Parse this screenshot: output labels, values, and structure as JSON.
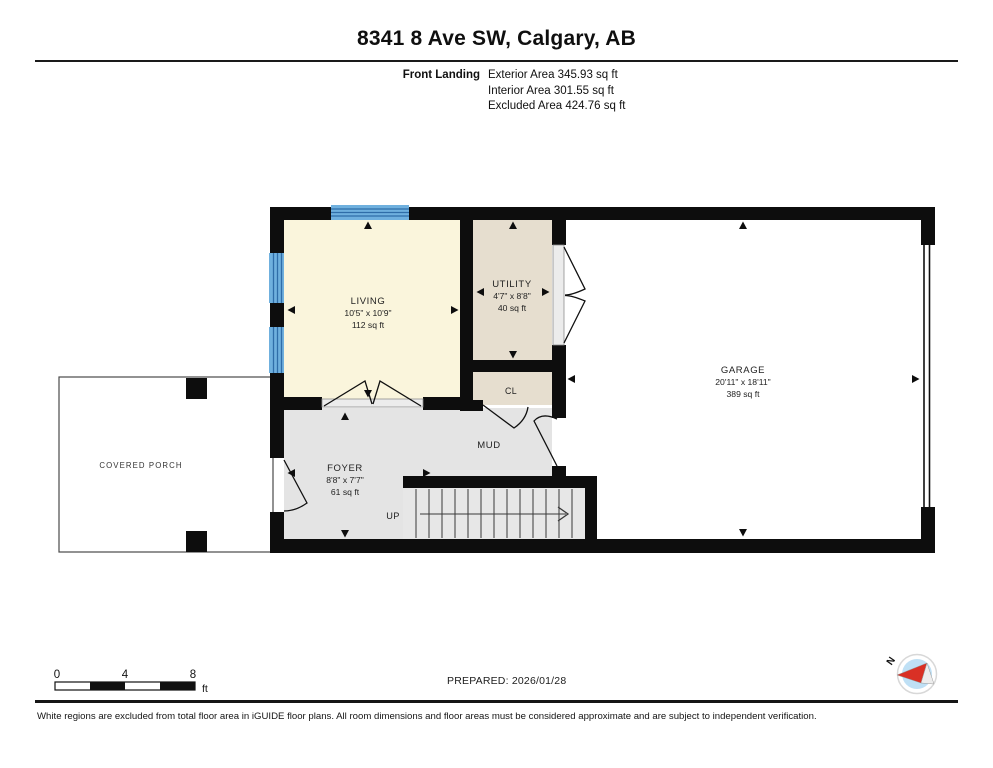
{
  "title": "8341 8 Ave SW, Calgary, AB",
  "header": {
    "floor_label": "Front Landing",
    "exterior_area": "Exterior Area 345.93 sq ft",
    "interior_area": "Interior Area 301.55 sq ft",
    "excluded_area": "Excluded Area 424.76 sq ft"
  },
  "rooms": {
    "living": {
      "name": "LIVING",
      "dims": "10'5\" x 10'9\"",
      "area": "112 sq ft"
    },
    "utility": {
      "name": "UTILITY",
      "dims": "4'7\" x 8'8\"",
      "area": "40 sq ft"
    },
    "garage": {
      "name": "GARAGE",
      "dims": "20'11\" x 18'11\"",
      "area": "389 sq ft"
    },
    "foyer": {
      "name": "FOYER",
      "dims": "8'8\" x 7'7\"",
      "area": "61 sq ft"
    }
  },
  "labels": {
    "mud": "MUD",
    "closet": "CL",
    "up": "UP",
    "covered_porch": "COVERED PORCH"
  },
  "scale_bar": {
    "zero": "0",
    "four": "4",
    "eight": "8",
    "unit": "ft"
  },
  "prepared": "PREPARED: 2026/01/28",
  "compass": {
    "north": "N"
  },
  "footer": "White regions are excluded from total floor area in iGUIDE floor plans. All room dimensions and floor areas must be considered approximate and are subject to independent verification.",
  "colors": {
    "wall": "#0d0d0d",
    "window_blue": "#6FB0DE",
    "window_stripe": "#2F6DA8",
    "living_fill": "#FAF5DC",
    "utility_fill": "#E6DECF",
    "floor_gray": "#E4E4E4",
    "sill_gray": "#ECECEC",
    "compass_red": "#D93025",
    "compass_blue": "#BFE0F5"
  }
}
